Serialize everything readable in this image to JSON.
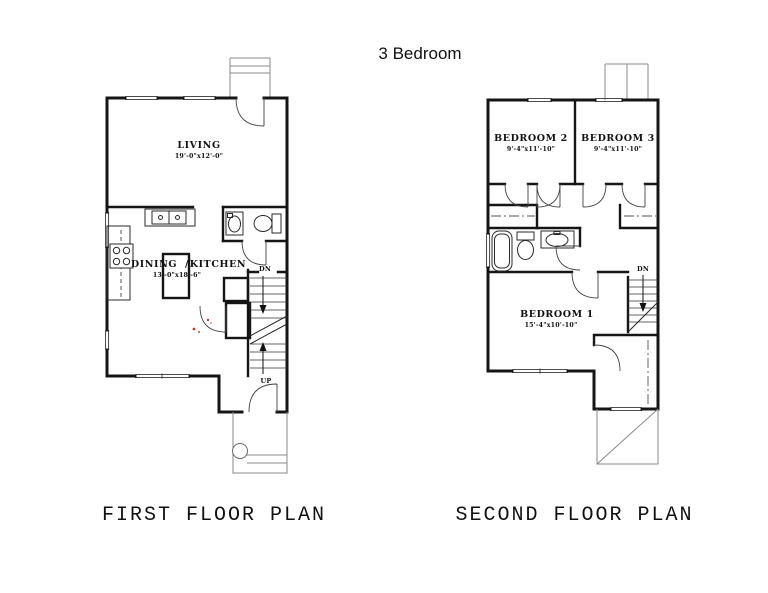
{
  "title": "3 Bedroom",
  "plans": {
    "first": {
      "caption": "FIRST FLOOR PLAN",
      "living_name": "LIVING",
      "living_dims": "19'-0\"x12'-0\"",
      "dining_name": "DINING",
      "divider": "/",
      "kitchen_name": "KITCHEN",
      "dining_kitchen_dims": "13'-0\"x18'-6\"",
      "stair_down": "DN",
      "stair_up": "UP"
    },
    "second": {
      "caption": "SECOND FLOOR PLAN",
      "bedroom2_name": "BEDROOM 2",
      "bedroom2_dims": "9'-4\"x11'-10\"",
      "bedroom3_name": "BEDROOM 3",
      "bedroom3_dims": "9'-4\"x11'-10\"",
      "bedroom1_name": "BEDROOM 1",
      "bedroom1_dims": "15'-4\"x10'-10\"",
      "stair_down": "DN"
    }
  },
  "colors": {
    "wall": "#151515",
    "background": "#ffffff",
    "accent_red": "#c0392b"
  }
}
